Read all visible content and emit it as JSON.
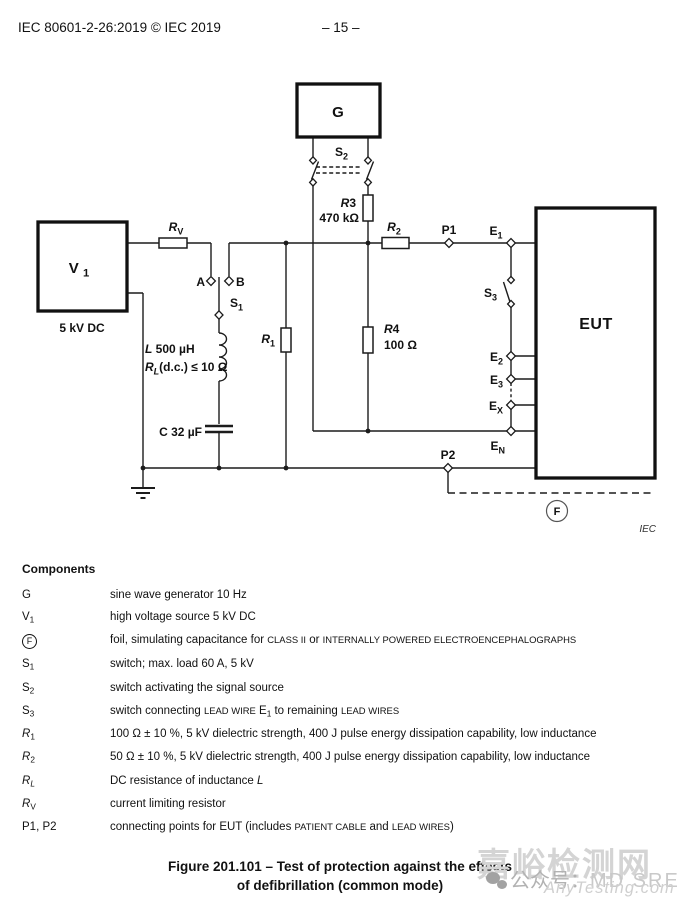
{
  "header": {
    "left": "IEC 80601-2-26:2019 © IEC 2019",
    "page": "– 15 –"
  },
  "diagram": {
    "labels": {
      "v1": [
        {
          "t": "V "
        },
        {
          "t": "1",
          "sub": true
        }
      ],
      "v1_rating": [
        {
          "t": "5 kV  DC"
        }
      ],
      "rv": [
        {
          "t": "R",
          "i": true
        },
        {
          "t": "V",
          "sub": true
        }
      ],
      "a": [
        {
          "t": "A"
        }
      ],
      "b": [
        {
          "t": "B"
        }
      ],
      "s1": [
        {
          "t": "S"
        },
        {
          "t": "1",
          "sub": true
        }
      ],
      "l_value": [
        {
          "t": "L",
          "i": true
        },
        {
          "t": "  500 µH"
        }
      ],
      "rl_value": [
        {
          "t": "R",
          "i": true
        },
        {
          "t": "L",
          "sub": true,
          "i": true
        },
        {
          "t": "(d.c.) ≤ 10 Ω"
        }
      ],
      "c_value": [
        {
          "t": "C 32  µF"
        }
      ],
      "r1": [
        {
          "t": "R",
          "i": true
        },
        {
          "t": "1",
          "sub": true
        }
      ],
      "g": [
        {
          "t": "G"
        }
      ],
      "s2": [
        {
          "t": "S"
        },
        {
          "t": "2",
          "sub": true
        }
      ],
      "r3": [
        {
          "t": "R",
          "i": true
        },
        {
          "t": "3"
        }
      ],
      "r3_value": [
        {
          "t": "470 kΩ"
        }
      ],
      "r2": [
        {
          "t": "R",
          "i": true
        },
        {
          "t": "2",
          "sub": true
        }
      ],
      "r4": [
        {
          "t": "R",
          "i": true
        },
        {
          "t": "4"
        }
      ],
      "r4_value": [
        {
          "t": "100 Ω"
        }
      ],
      "p1": [
        {
          "t": "P1"
        }
      ],
      "e1": [
        {
          "t": "E"
        },
        {
          "t": "1",
          "sub": true
        }
      ],
      "s3": [
        {
          "t": "S"
        },
        {
          "t": "3",
          "sub": true
        }
      ],
      "e2": [
        {
          "t": "E"
        },
        {
          "t": "2",
          "sub": true
        }
      ],
      "e3": [
        {
          "t": "E"
        },
        {
          "t": "3",
          "sub": true
        }
      ],
      "ex": [
        {
          "t": "E"
        },
        {
          "t": "X",
          "sub": true
        }
      ],
      "en": [
        {
          "t": "E"
        },
        {
          "t": "N",
          "sub": true
        }
      ],
      "p2": [
        {
          "t": "P2"
        }
      ],
      "eut": [
        {
          "t": "EUT"
        }
      ],
      "f": [
        {
          "t": "F"
        }
      ],
      "iec": [
        {
          "t": "IEC"
        }
      ]
    }
  },
  "components": {
    "title": "Components",
    "rows": [
      {
        "sym": [
          {
            "t": "G"
          }
        ],
        "desc": [
          {
            "t": "sine wave generator 10 Hz"
          }
        ]
      },
      {
        "sym": [
          {
            "t": "V"
          },
          {
            "t": "1",
            "sub": true
          }
        ],
        "desc": [
          {
            "t": "high voltage source 5 kV DC"
          }
        ]
      },
      {
        "sym": [
          {
            "t": "F",
            "circled": true
          }
        ],
        "desc": [
          {
            "t": "foil, simulating capacitance for "
          },
          {
            "t": "CLASS II",
            "sc": true
          },
          {
            "t": " or "
          },
          {
            "t": "INTERNALLY POWERED ELECTROENCEPHALOGRAPHS",
            "sc": true
          }
        ]
      },
      {
        "sym": [
          {
            "t": "S"
          },
          {
            "t": "1",
            "sub": true
          }
        ],
        "desc": [
          {
            "t": "switch; max. load 60 A, 5 kV"
          }
        ]
      },
      {
        "sym": [
          {
            "t": "S"
          },
          {
            "t": "2",
            "sub": true
          }
        ],
        "desc": [
          {
            "t": "switch activating the signal source"
          }
        ]
      },
      {
        "sym": [
          {
            "t": "S"
          },
          {
            "t": "3",
            "sub": true
          }
        ],
        "desc": [
          {
            "t": "switch connecting "
          },
          {
            "t": "LEAD WIRE",
            "sc": true
          },
          {
            "t": " E"
          },
          {
            "t": "1",
            "sub": true
          },
          {
            "t": " to remaining "
          },
          {
            "t": "LEAD WIRES",
            "sc": true
          }
        ]
      },
      {
        "sym": [
          {
            "t": "R",
            "i": true
          },
          {
            "t": "1",
            "sub": true
          }
        ],
        "desc": [
          {
            "t": "100 Ω ± 10 %, 5 kV dielectric strength, 400 J pulse energy dissipation capability, low inductance"
          }
        ]
      },
      {
        "sym": [
          {
            "t": "R",
            "i": true
          },
          {
            "t": "2",
            "sub": true
          }
        ],
        "desc": [
          {
            "t": "50 Ω ± 10 %, 5 kV dielectric strength, 400 J pulse energy dissipation capability, low inductance"
          }
        ]
      },
      {
        "sym": [
          {
            "t": "R",
            "i": true
          },
          {
            "t": "L",
            "sub": true,
            "i": true
          }
        ],
        "desc": [
          {
            "t": "DC resistance of inductance "
          },
          {
            "t": "L",
            "i": true
          }
        ]
      },
      {
        "sym": [
          {
            "t": "R",
            "i": true
          },
          {
            "t": "V",
            "sub": true
          }
        ],
        "desc": [
          {
            "t": "current limiting resistor"
          }
        ]
      },
      {
        "sym": [
          {
            "t": "P1, P2"
          }
        ],
        "desc": [
          {
            "t": "connecting points for EUT (includes "
          },
          {
            "t": "PATIENT CABLE",
            "sc": true
          },
          {
            "t": " and "
          },
          {
            "t": "LEAD WIRES",
            "sc": true
          },
          {
            "t": ")"
          }
        ]
      }
    ]
  },
  "caption": {
    "line1": "Figure 201.101 – Test of protection against the effects",
    "line2": "of defibrillation (common mode)"
  },
  "watermark": {
    "cn": "嘉峪检测网",
    "account_prefix": "公众号：",
    "account_name": "MD SRE",
    "site": "AnyTesting.com"
  },
  "colors": {
    "ink": "#111111",
    "watermark_light": "#d4d4d4",
    "watermark_mid": "#b2b2b2"
  }
}
